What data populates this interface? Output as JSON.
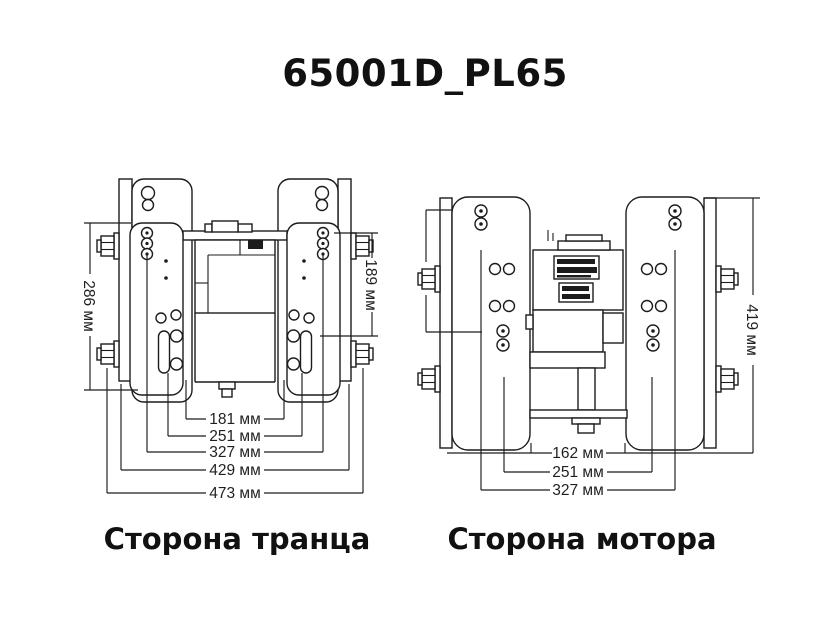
{
  "title": "65001D_PL65",
  "views": {
    "transom": {
      "label": "Сторона транца",
      "horizontal_dims": [
        "181 мм",
        "251 мм",
        "327 мм",
        "429 мм",
        "473 мм"
      ],
      "vertical_dims": [
        "286 мм",
        "189 мм"
      ]
    },
    "motor": {
      "label": "Сторона мотора",
      "horizontal_dims": [
        "162 мм",
        "251 мм",
        "327 мм"
      ],
      "vertical_dims": [
        "419 мм"
      ]
    }
  },
  "colors": {
    "ink": "#1c1c1c",
    "background": "#ffffff"
  }
}
